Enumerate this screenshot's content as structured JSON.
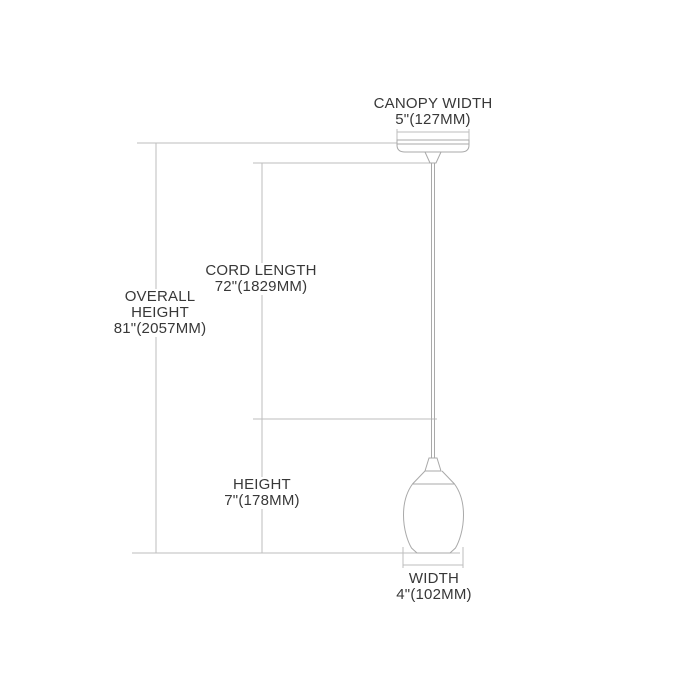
{
  "diagram": {
    "labels": {
      "canopy_width": {
        "title": "CANOPY WIDTH",
        "value": "5\"(127MM)"
      },
      "overall_height": {
        "line1": "OVERALL",
        "line2": "HEIGHT",
        "value": "81\"(2057MM)"
      },
      "cord_length": {
        "title": "CORD LENGTH",
        "value": "72\"(1829MM)"
      },
      "shade_height": {
        "title": "HEIGHT",
        "value": "7\"(178MM)"
      },
      "shade_width": {
        "title": "WIDTH",
        "value": "4\"(102MM)"
      }
    },
    "colors": {
      "dimension_line": "#bdbdbd",
      "fixture_line": "#a9a9a9",
      "text": "#383838",
      "background": "#ffffff"
    }
  }
}
